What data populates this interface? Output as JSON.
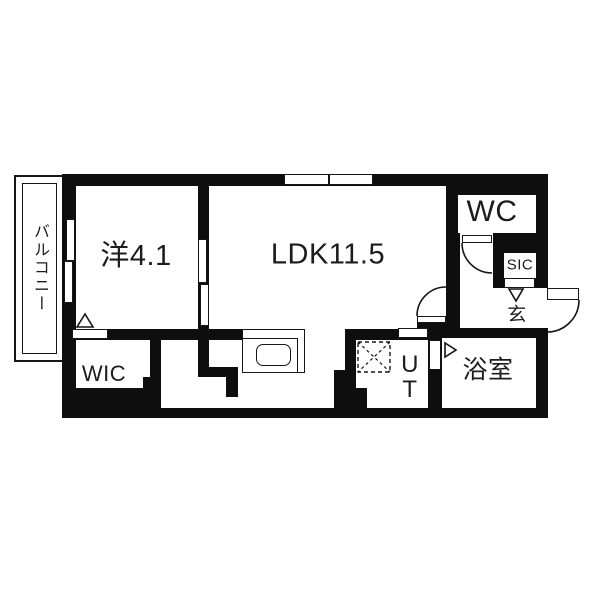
{
  "plan": {
    "title": "apartment-floor-plan",
    "wall_color": "#0e0e0e",
    "rooms": {
      "balcony": {
        "label": "バルコニー"
      },
      "bedroom": {
        "label": "洋4.1"
      },
      "ldk": {
        "label": "LDK11.5"
      },
      "wc": {
        "label": "WC"
      },
      "sic": {
        "label": "SIC"
      },
      "genkan": {
        "label": "玄"
      },
      "bathroom": {
        "label": "浴室"
      },
      "wic": {
        "label": "WIC"
      },
      "utility": {
        "label_line1": "U",
        "label_line2": "T"
      }
    }
  }
}
